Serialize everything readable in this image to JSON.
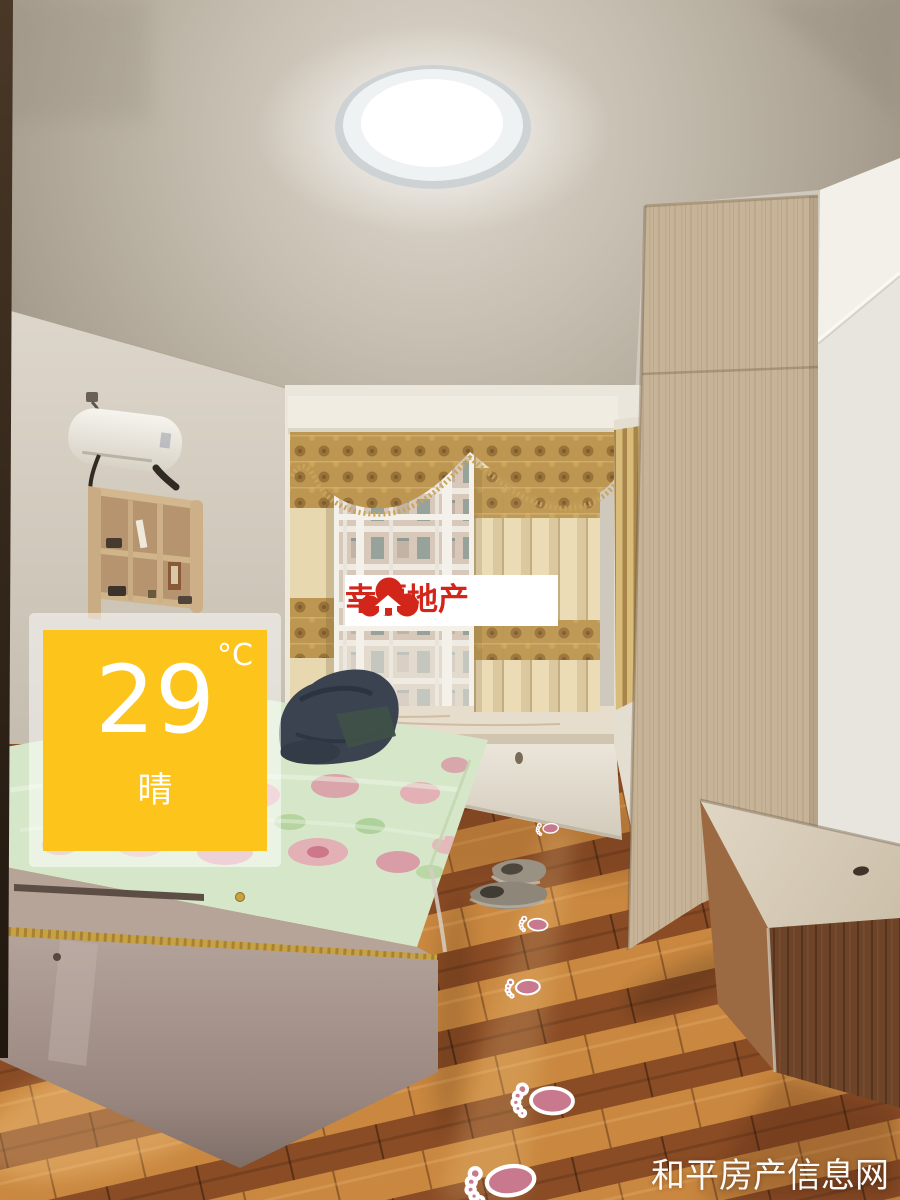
{
  "overlay": {
    "weather_widget": {
      "temperature": "29",
      "unit": "°C",
      "condition": "晴",
      "panel_color": "#FDC41B"
    },
    "agency_watermark": {
      "brand_name": "幸福地产",
      "brand_color": "#D3261B",
      "icon": "red-clouds-house-logo"
    },
    "site_watermark": {
      "text": "和平房产信息网",
      "color": "#FFFFFF"
    }
  },
  "scene": {
    "kind": "bedroom-listing-photo",
    "palette": {
      "ceiling": "#B9B0A3",
      "wall": "#D9D2C6",
      "wardrobe_wood": "#C7B498",
      "curtain_cream": "#E8D8B0",
      "curtain_gold": "#BD9752",
      "bedsheet_green": "#D6E6C8",
      "floor_light": "#C9873F",
      "floor_dark": "#8A4C25"
    }
  }
}
